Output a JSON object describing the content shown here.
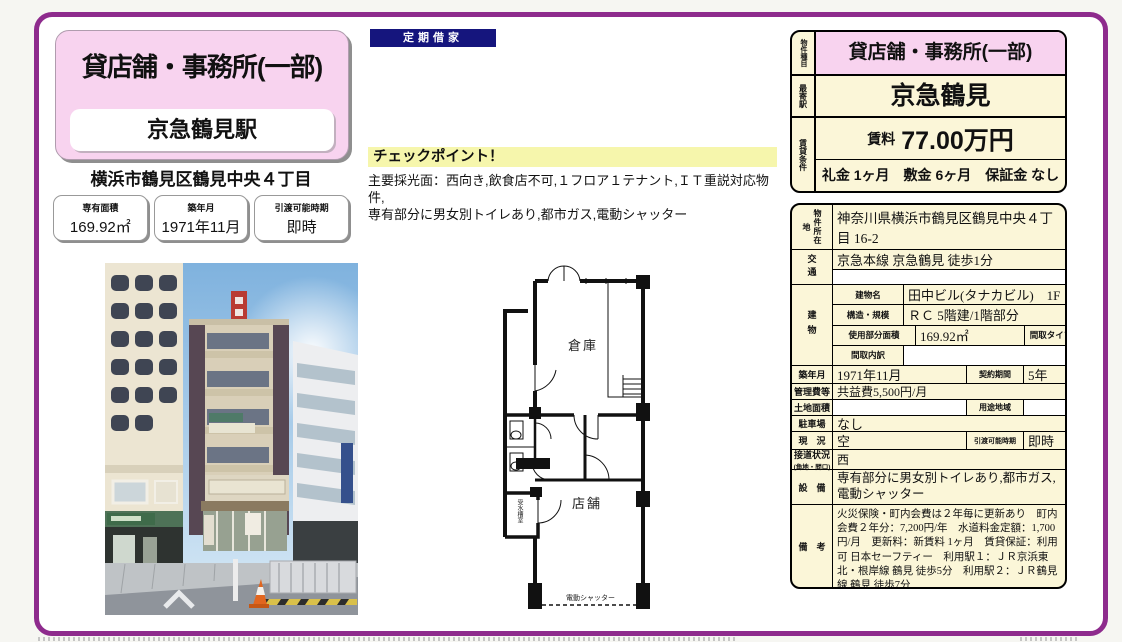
{
  "title_panel": {
    "property_type": "貸店舗・事務所(一部)",
    "station": "京急鶴見駅",
    "address": "横浜市鶴見区鶴見中央４丁目",
    "info_boxes": [
      {
        "label": "専有面積",
        "value": "169.92㎡"
      },
      {
        "label": "築年月",
        "value": "1971年11月"
      },
      {
        "label": "引渡可能時期",
        "value": "即時"
      }
    ]
  },
  "lease_badge": "定期借家",
  "checkpoint": {
    "title": "チェックポイント！",
    "lines": [
      "主要採光面：西向き,飲食店不可,１フロア１テナント,ＩＴ重説対応物件,",
      "専有部分に男女別トイレあり,都市ガス,電動シャッター"
    ]
  },
  "summary": {
    "type_label": "物件種目",
    "type_value": "貸店舗・事務所(一部)",
    "station_label": "最寄駅",
    "station_value": "京急鶴見",
    "terms_label": "賃貸条件",
    "rent_label": "賃料",
    "rent_value": "77.00万円",
    "terms_value": "礼金 1ヶ月　敷金 6ヶ月　保証金 なし"
  },
  "detail": {
    "location_label": "物件所在地",
    "location": "神奈川県横浜市鶴見区鶴見中央４丁目 16-2",
    "access_label": "交通",
    "access": "京急本線 京急鶴見 徒歩1分",
    "building_label": "建物",
    "building_name_label": "建物名",
    "building_name": "田中ビル(タナカビル)　1F",
    "structure_label": "構造・規模",
    "structure": "ＲＣ 5階建/1階部分",
    "used_area_label": "使用部分面積",
    "used_area": "169.92㎡",
    "layout_type_label": "間取タイプ",
    "layout_type": "",
    "layout_detail_label": "間取内訳",
    "layout_detail": "",
    "built_label": "築年月",
    "built": "1971年11月",
    "contract_label": "契約期間",
    "contract": "5年",
    "mgmt_label": "管理費等",
    "mgmt": "共益費5,500円/月",
    "land_label": "土地面積",
    "land": "",
    "zoning_label": "用途地域",
    "zoning": "",
    "parking_label": "駐車場",
    "parking": "なし",
    "status_label": "現　況",
    "status": "空",
    "handover_label": "引渡可能時期",
    "handover": "即時",
    "road_label": "接道状況",
    "road_sublabel": "(角地・間口)",
    "road": "西",
    "equipment_label": "設　備",
    "equipment": "専有部分に男女別トイレあり,都市ガス,電動シャッター",
    "notes_label": "備　考",
    "notes": "火災保険・町内会費は２年毎に更新あり　町内会費２年分：7,200円/年　水道料金定額：1,700円/月　更新料：新賃料 1ヶ月　賃貸保証：利用可 日本セーフティー　利用駅１：ＪＲ京浜東北・根岸線 鶴見 徒歩5分　利用駅２：ＪＲ鶴見線 鶴見 徒歩7分"
  },
  "floorplan": {
    "warehouse": "倉庫",
    "shop": "店舗",
    "water_tank": "受水槽室",
    "shutter": "電動シャッター"
  },
  "colors": {
    "border_purple": "#8e2b8d",
    "pink": "#f8d3ef",
    "cream": "#fbf6d8",
    "navy": "#15157d",
    "highlight_yellow": "#f6f6ac"
  }
}
